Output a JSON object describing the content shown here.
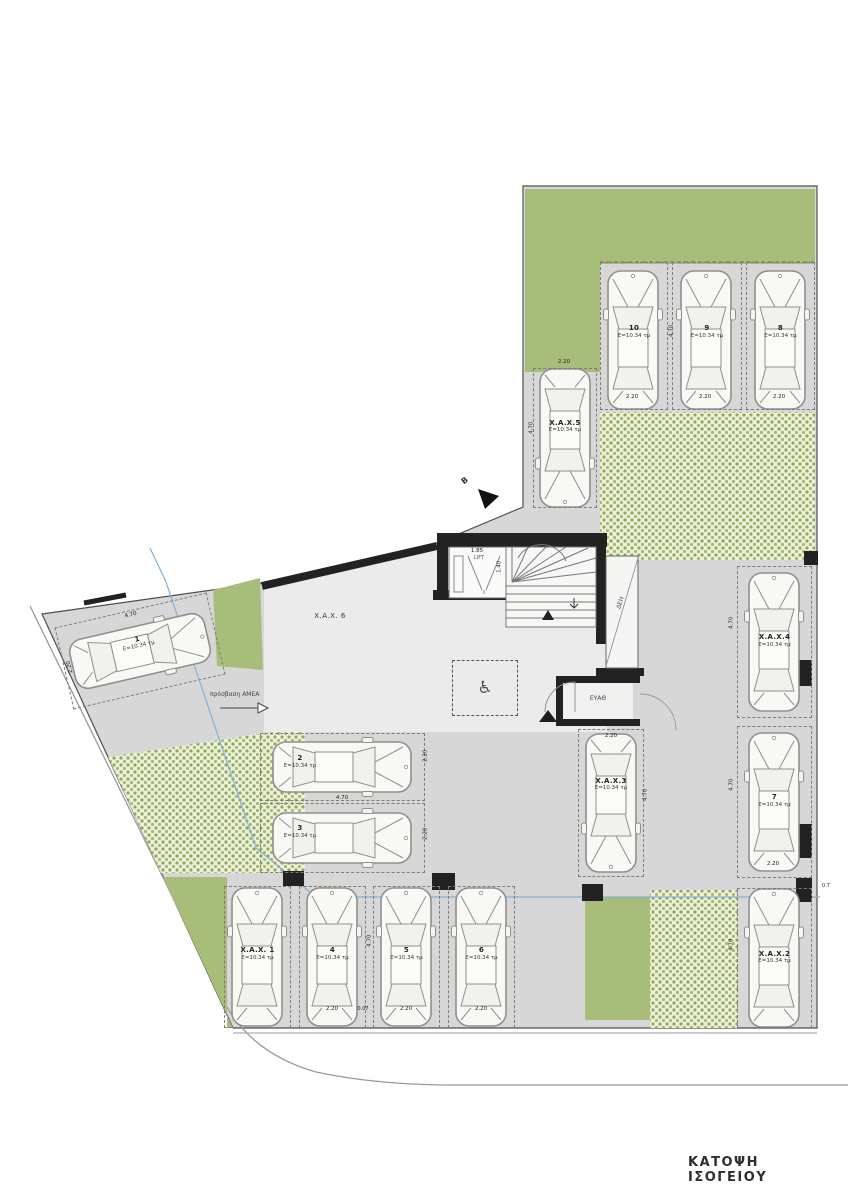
{
  "title": "ΚΑΤΟΨΗ ΙΣΟΓΕΙΟΥ",
  "colors": {
    "garden_green": "#a8bd7a",
    "paver_green": "#8ca95c",
    "wall": "#222222",
    "reference_blue": "#7fb2d9"
  },
  "icons": {
    "wheelchair_icon": "♿"
  },
  "section_mark": {
    "label": "B"
  },
  "access": {
    "label": "πρόσβαση ΑΜΕΑ"
  },
  "building": {
    "hall_label": "X.A.X. 6",
    "lift_label": "LIFT",
    "utility_deh": "ΔΕΗ",
    "utility_eyath": "ΕΥΑΘ"
  },
  "dims": {
    "bay_width": "2.20",
    "bay_length": "4.70",
    "lift_width": "1.85",
    "lift_depth": "1.40",
    "gap": "0.07",
    "edge_offset": "0.7"
  },
  "parking": {
    "spaces": {
      "s10": {
        "label": "10",
        "area": "E=10.34 τμ"
      },
      "s9": {
        "label": "9",
        "area": "E=10.34 τμ"
      },
      "s8": {
        "label": "8",
        "area": "E=10.34 τμ"
      },
      "xax5": {
        "label": "X.A.X.5",
        "area": "E=10.34 τμ"
      },
      "xax4": {
        "label": "X.A.X.4",
        "area": "E=10.34 τμ"
      },
      "s7": {
        "label": "7",
        "area": "E=10.34 τμ"
      },
      "xax2": {
        "label": "X.A.X.2",
        "area": "E=10.34 τμ"
      },
      "s1": {
        "label": "1",
        "area": "E=10.34 τμ"
      },
      "s2": {
        "label": "2",
        "area": "E=10.34 τμ"
      },
      "s3": {
        "label": "3",
        "area": "E=10.34 τμ"
      },
      "xax3": {
        "label": "X.A.X.3",
        "area": "E=10.34 τμ"
      },
      "xax1": {
        "label": "X.A.X. 1",
        "area": "E=10.34 τμ"
      },
      "s4": {
        "label": "4",
        "area": "E=10.34 τμ"
      },
      "s5": {
        "label": "5",
        "area": "E=10.34 τμ"
      },
      "s6": {
        "label": "6",
        "area": "E=10.34 τμ"
      }
    }
  }
}
